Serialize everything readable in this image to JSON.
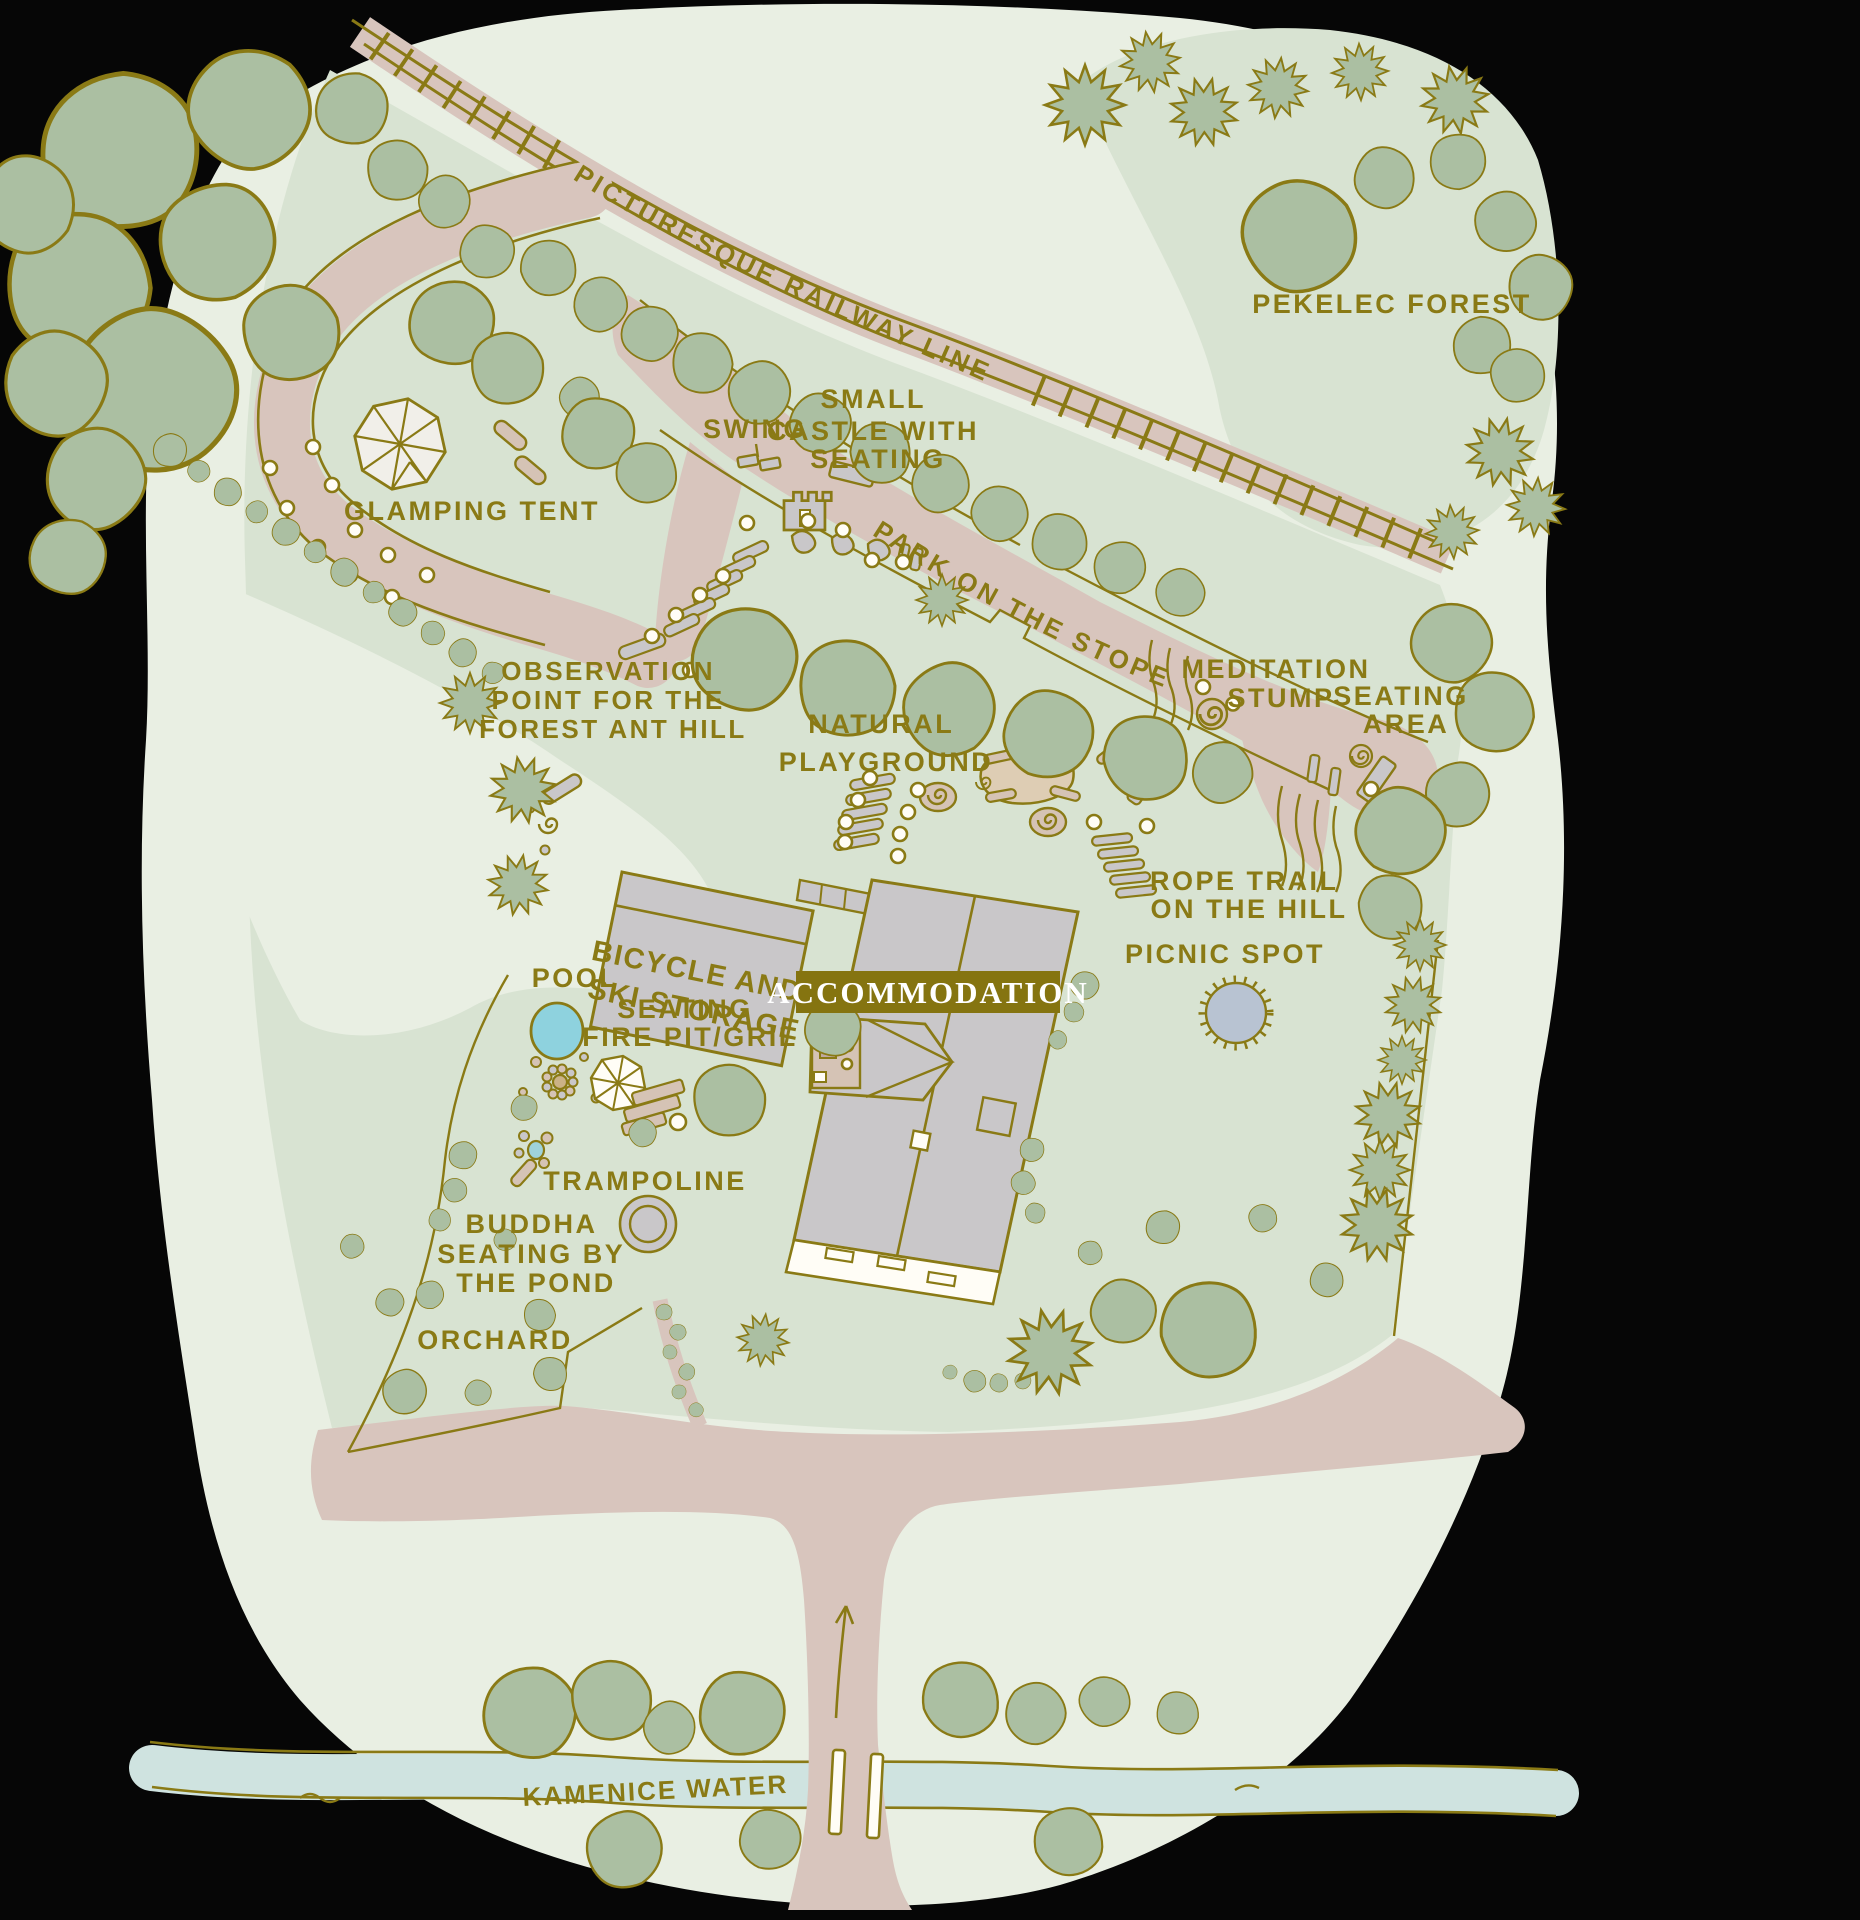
{
  "colors": {
    "base": "#e9efe3",
    "grounds": "#d8e3d2",
    "tree": "#abbfa2",
    "outline": "#8a7a15",
    "path": "#d8c5bd",
    "stream": "#cfe3e0",
    "pond": "#9fd3da",
    "pool": "#8ed2de",
    "picnic": "#b8c3d2",
    "building": "#c9c7c9",
    "tan": "#d5c3b5",
    "sand": "#decdb4",
    "white": "#fffdf6",
    "badge": "#857410",
    "badge_text": "#ffffff"
  },
  "labels": {
    "railway": "PICTURESQUE RAILWAY LINE",
    "forest": "PEKELEC FOREST",
    "glamping": "GLAMPING TENT",
    "swing": "SWING",
    "castle": [
      "SMALL",
      "CASTLE WITH",
      "SEATING"
    ],
    "park": "PARK ON THE STOPE",
    "meditation": [
      "MEDITATION",
      "STUMP"
    ],
    "seating_area": [
      "SEATING",
      "AREA"
    ],
    "observation": [
      "OBSERVATION",
      "POINT FOR THE",
      "FOREST ANT HILL"
    ],
    "playground": [
      "NATURAL",
      "PLAYGROUND"
    ],
    "storage": [
      "BICYCLE AND",
      "SKI STORAGE"
    ],
    "rope_trail": [
      "ROPE TRAIL",
      "ON THE HILL"
    ],
    "picnic": "PICNIC SPOT",
    "accommodation": "ACCOMMODATION",
    "pool": "POOL",
    "fire_pit": [
      "SEATING",
      "FIRE PIT/GRIL"
    ],
    "trampoline": "TRAMPOLINE",
    "buddha": [
      "BUDDHA",
      "SEATING BY",
      "THE POND"
    ],
    "orchard": "ORCHARD",
    "stream": "KAMENICE WATER STREAM"
  }
}
